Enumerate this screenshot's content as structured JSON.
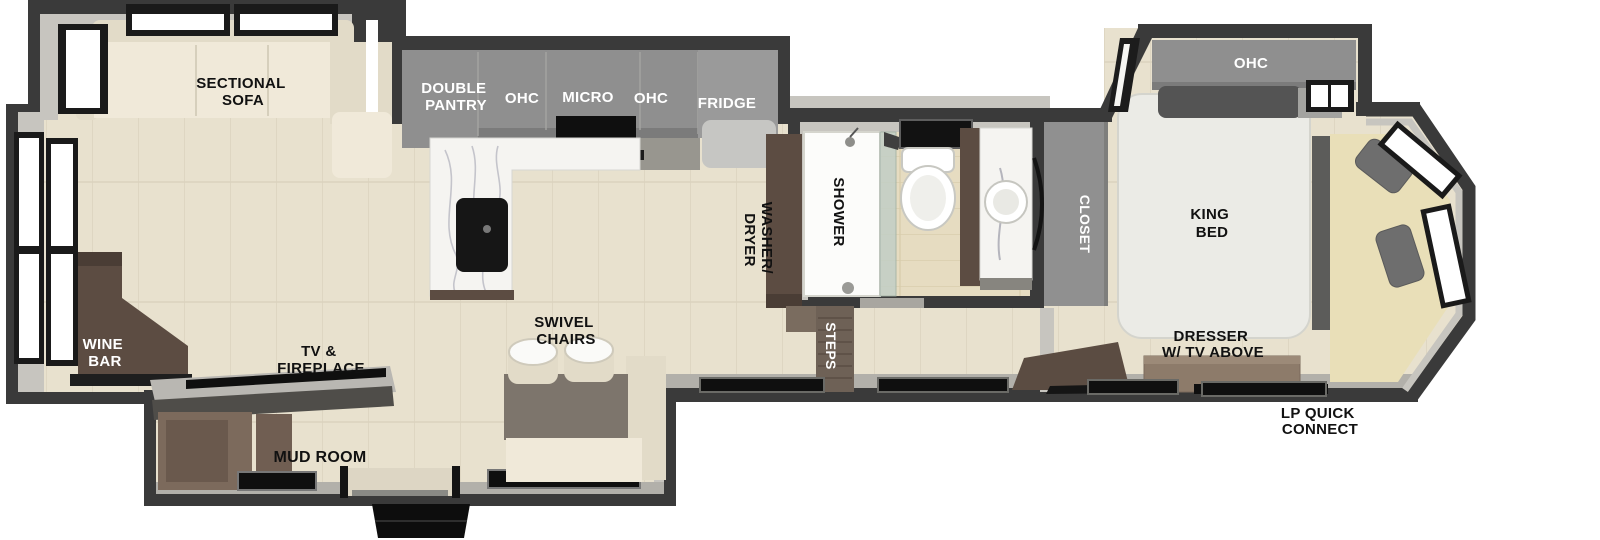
{
  "floorplan": {
    "living_area": {
      "sectional_sofa_line1": "SECTIONAL",
      "sectional_sofa_line2": "SOFA",
      "wine_bar_line1": "WINE",
      "wine_bar_line2": "BAR",
      "tv_fireplace_line1": "TV &",
      "tv_fireplace_line2": "FIREPLACE",
      "swivel_chairs_line1": "SWIVEL",
      "swivel_chairs_line2": "CHAIRS"
    },
    "kitchen": {
      "double_pantry_line1": "DOUBLE",
      "double_pantry_line2": "PANTRY",
      "ohc_left": "OHC",
      "micro": "MICRO",
      "ohc_right": "OHC",
      "fridge": "FRIDGE"
    },
    "mid_section": {
      "washer_dryer_line1": "WASHER/",
      "washer_dryer_line2": "DRYER",
      "shower": "SHOWER",
      "steps": "STEPS",
      "mud_room": "MUD ROOM"
    },
    "bedroom": {
      "closet": "CLOSET",
      "ohc": "OHC",
      "king_bed_line1": "KING",
      "king_bed_line2": "BED",
      "dresser_line1": "DRESSER",
      "dresser_line2": "W/ TV ABOVE"
    },
    "exterior": {
      "lp_line1": "LP QUICK",
      "lp_line2": "CONNECT"
    }
  },
  "colors": {
    "wall": "#3a3a3a",
    "lining": "#c7c5bf",
    "sill": "#b2b0aa",
    "floor": "#e8e1ce",
    "floor_line": "#dad2be",
    "tile": "#e6dcc1",
    "tile_line": "#d7cbaa",
    "cabinet_gray": "#8f8f8f",
    "cabinet_gray_dark": "#7b7b7b",
    "counter_gray": "#98968f",
    "marble": "#f5f4f1",
    "sink_black": "#161616",
    "brown": "#5c4c42",
    "brown_light": "#7c6a5c",
    "steps_brown": "#6e6156",
    "cream": "#f0e9d9",
    "cream_dark": "#e2dbc8",
    "bench_cream": "#e9dfb8",
    "bed_white": "#ebebe6",
    "pillow_gray": "#545454",
    "table_gray": "#7d756c",
    "console_gray": "#b9b7b2",
    "console_dark": "#4f4d49",
    "tv_black": "#0f0f0f",
    "window_white": "#ffffff",
    "window_frame": "#1a1a1a",
    "glass_green": "#c2cfc6",
    "fridge_front": "#c6c6c3",
    "closet_gray": "#909090",
    "dresser_brown": "#8d7b6a",
    "label_dark": "#111111",
    "label_light": "#ffffff"
  }
}
